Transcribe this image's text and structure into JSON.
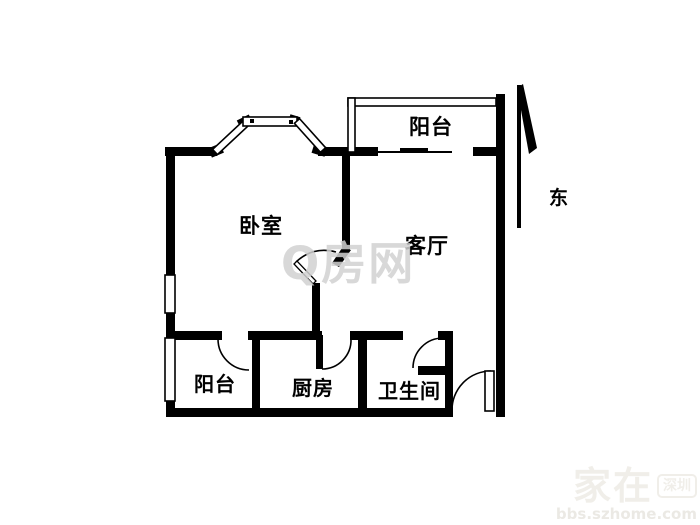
{
  "floorplan": {
    "rooms": [
      {
        "id": "balcony-top",
        "label": "阳台"
      },
      {
        "id": "bedroom",
        "label": "卧室"
      },
      {
        "id": "living-room",
        "label": "客厅"
      },
      {
        "id": "balcony-bottom",
        "label": "阳台"
      },
      {
        "id": "kitchen",
        "label": "厨房"
      },
      {
        "id": "bathroom",
        "label": "卫生间"
      }
    ],
    "compass": {
      "direction_label": "东"
    },
    "colors": {
      "wall": "#000000",
      "background": "#ffffff",
      "watermark_center": "#d2d2d2",
      "watermark_corner": "#f0eee9"
    }
  },
  "watermarks": {
    "center_logo": "Q房网",
    "corner_brand": "家在",
    "corner_badge": "深圳",
    "corner_url": "bbs.szhome.com"
  }
}
